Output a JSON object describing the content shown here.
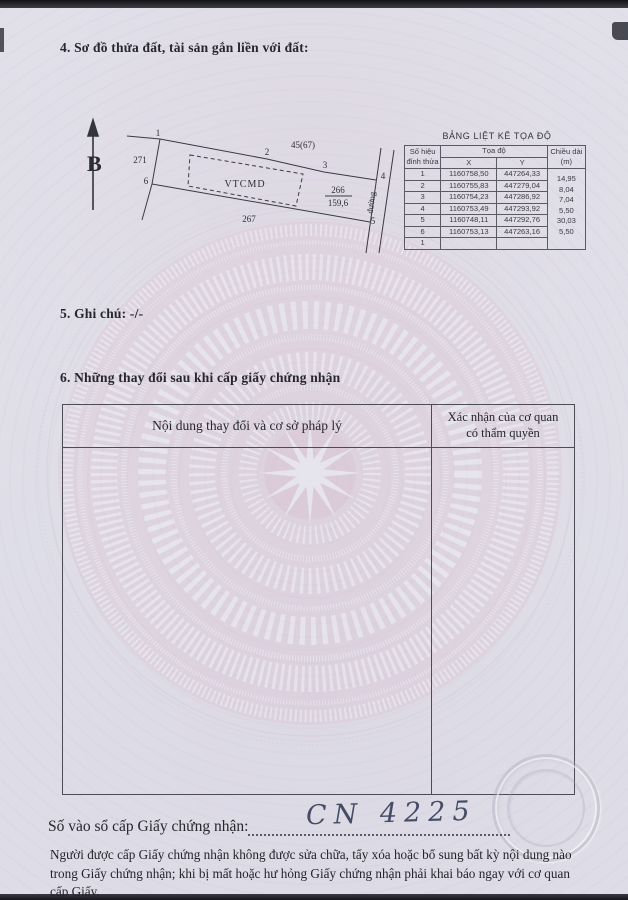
{
  "sections": {
    "s4_heading": "4. Sơ đồ thửa đất, tài sản gắn liền với đất:",
    "s5_heading": "5. Ghi chú:",
    "s5_value": "-/-",
    "s6_heading": "6. Những thay đổi sau khi cấp giấy chứng nhận"
  },
  "diagram": {
    "north_label": "B",
    "parcel_label": "VTCMD",
    "parcel_number": "266",
    "parcel_area": "159,6",
    "adjacent_left": "271",
    "adjacent_top": "45(67)",
    "adjacent_bottom": "267",
    "road_label": "đường",
    "vertex_labels": [
      "1",
      "2",
      "3",
      "4",
      "5",
      "6"
    ]
  },
  "coord_table": {
    "title": "BẢNG LIỆT KÊ TỌA ĐỘ",
    "col_vertex_line1": "Số hiệu",
    "col_vertex_line2": "đỉnh thửa",
    "col_coord": "Tọa độ",
    "col_x": "X",
    "col_y": "Y",
    "col_length_line1": "Chiều dài",
    "col_length_line2": "(m)",
    "rows": [
      {
        "id": "1",
        "x": "1160758,50",
        "y": "447264,33"
      },
      {
        "id": "2",
        "x": "1160755,83",
        "y": "447279,04"
      },
      {
        "id": "3",
        "x": "1160754,23",
        "y": "447286,92"
      },
      {
        "id": "4",
        "x": "1160753,49",
        "y": "447293,92"
      },
      {
        "id": "5",
        "x": "1160748,11",
        "y": "447292,76"
      },
      {
        "id": "6",
        "x": "1160753,13",
        "y": "447263,16"
      },
      {
        "id": "1",
        "x": "",
        "y": ""
      }
    ],
    "lengths": [
      "14,95",
      "8,04",
      "7,04",
      "5,50",
      "30,03",
      "5,50"
    ]
  },
  "changes_table": {
    "col1_header": "Nội dung thay đổi và cơ sở pháp lý",
    "col2_header_line1": "Xác nhận của cơ quan",
    "col2_header_line2": "có thẩm quyền"
  },
  "footer": {
    "register_label": "Số vào sổ cấp Giấy chứng nhận:",
    "register_value": "CN 4225",
    "notice": "Người được cấp Giấy chứng nhận không được sửa chữa, tẩy xóa hoặc bổ sung bất kỳ nội dung nào trong Giấy chứng nhận; khi bị mất hoặc hư hỏng Giấy chứng nhận phải khai báo ngay với cơ quan cấp Giấy."
  },
  "colors": {
    "drum_pink": "#dcb9ca",
    "pattern_white": "#eef0f7",
    "ink_handwriting": "#454c66",
    "table_border": "#4c4c55"
  }
}
